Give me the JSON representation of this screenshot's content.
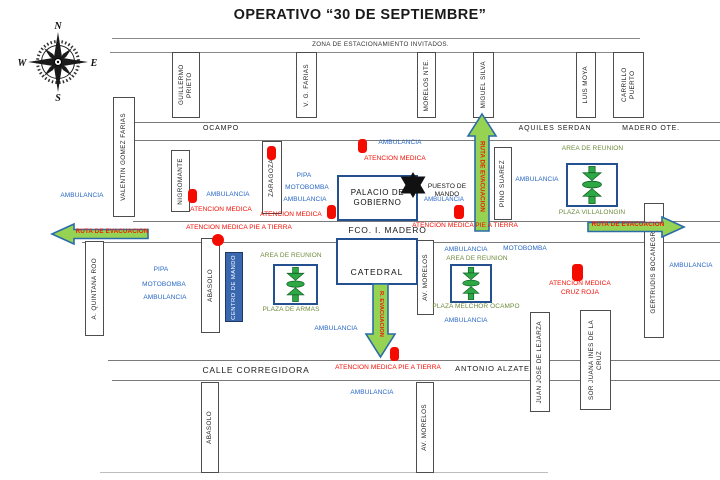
{
  "title": "OPERATIVO “30 DE SEPTIEMBRE”",
  "compass": {
    "n": "N",
    "e": "E",
    "s": "S",
    "w": "W"
  },
  "streets": {
    "zona_estacionamiento": "ZONA DE ESTACIONAMIENTO INVITADOS.",
    "ocampo": "OCAMPO",
    "aquiles_serdan": "AQUILES SERDAN",
    "madero_ote": "MADERO OTE.",
    "fco_i_madero": "FCO. I. MADERO",
    "calle_corregidora": "CALLE CORREGIDORA",
    "antonio_alzate": "ANTONIO ALZATE",
    "guillermo_prieto": "GUILLERMO PRIETO",
    "vg_farias": "V. G. FARIAS",
    "morelos_nte": "MORELOS NTE.",
    "miguel_silva": "MIGUEL SILVA",
    "luis_moya": "LUIS MOYA",
    "carrillo_puerto": "CARRILLO PUERTO",
    "valentin_gomez_farias": "VALENTIN GOMEZ FARIAS",
    "nigromante": "NIGROMANTE",
    "zaragoza": "ZARAGOZA",
    "pino_suarez": "PINO SUAREZ",
    "a_quintana_roo": "A. QUINTANA ROO",
    "abasolo": "ABASOLO",
    "av_morelos": "AV. MORELOS",
    "gertrudis_bocanegra": "GERTRUDIS BOCANEGRA",
    "juan_jose_de_lejarza": "JUAN JOSE DE LEJARZA",
    "sor_juana_ines": "SOR JUANA INES DE LA CRUZ"
  },
  "buildings": {
    "palacio_gobierno": "PALACIO DE GOBIERNO",
    "catedral": "CATEDRAL",
    "centro_de_mando": "CENTRO DE MANDO",
    "puesto_de_mando": "PUESTO DE MANDO"
  },
  "plazas": {
    "area_de_reunion": "AREA DE REUNION",
    "plaza_de_armas": "PLAZA DE ARMAS",
    "plaza_villalongin": "PLAZA VILLALONGIN",
    "plaza_melchor_ocampo": "PLAZA MELCHOR OCAMPO"
  },
  "routes": {
    "ruta_de_evacuacion": "RUTA DE EVACUACION",
    "r_evacuacion": "R. EVACUACION"
  },
  "resources": {
    "ambulancia": "AMBULANCIA",
    "pipa": "PIPA",
    "motobomba": "MOTOBOMBA",
    "atencion_medica": "ATENCION MEDICA",
    "atencion_medica_pie_a_tierra": "ATENCION MEDICA PIE A TIERRA",
    "cruz_roja": "CRUZ ROJA"
  },
  "colors": {
    "resource_blue": "#2766C4",
    "medical_red": "#F40B00",
    "plaza_olive": "#6E8B3D",
    "route_green_fill": "#97D353",
    "route_border_blue": "#2A6CA8",
    "building_border_blue": "#24508F",
    "command_box_blue": "#3A68B0",
    "assembly_green": "#2EA845"
  }
}
